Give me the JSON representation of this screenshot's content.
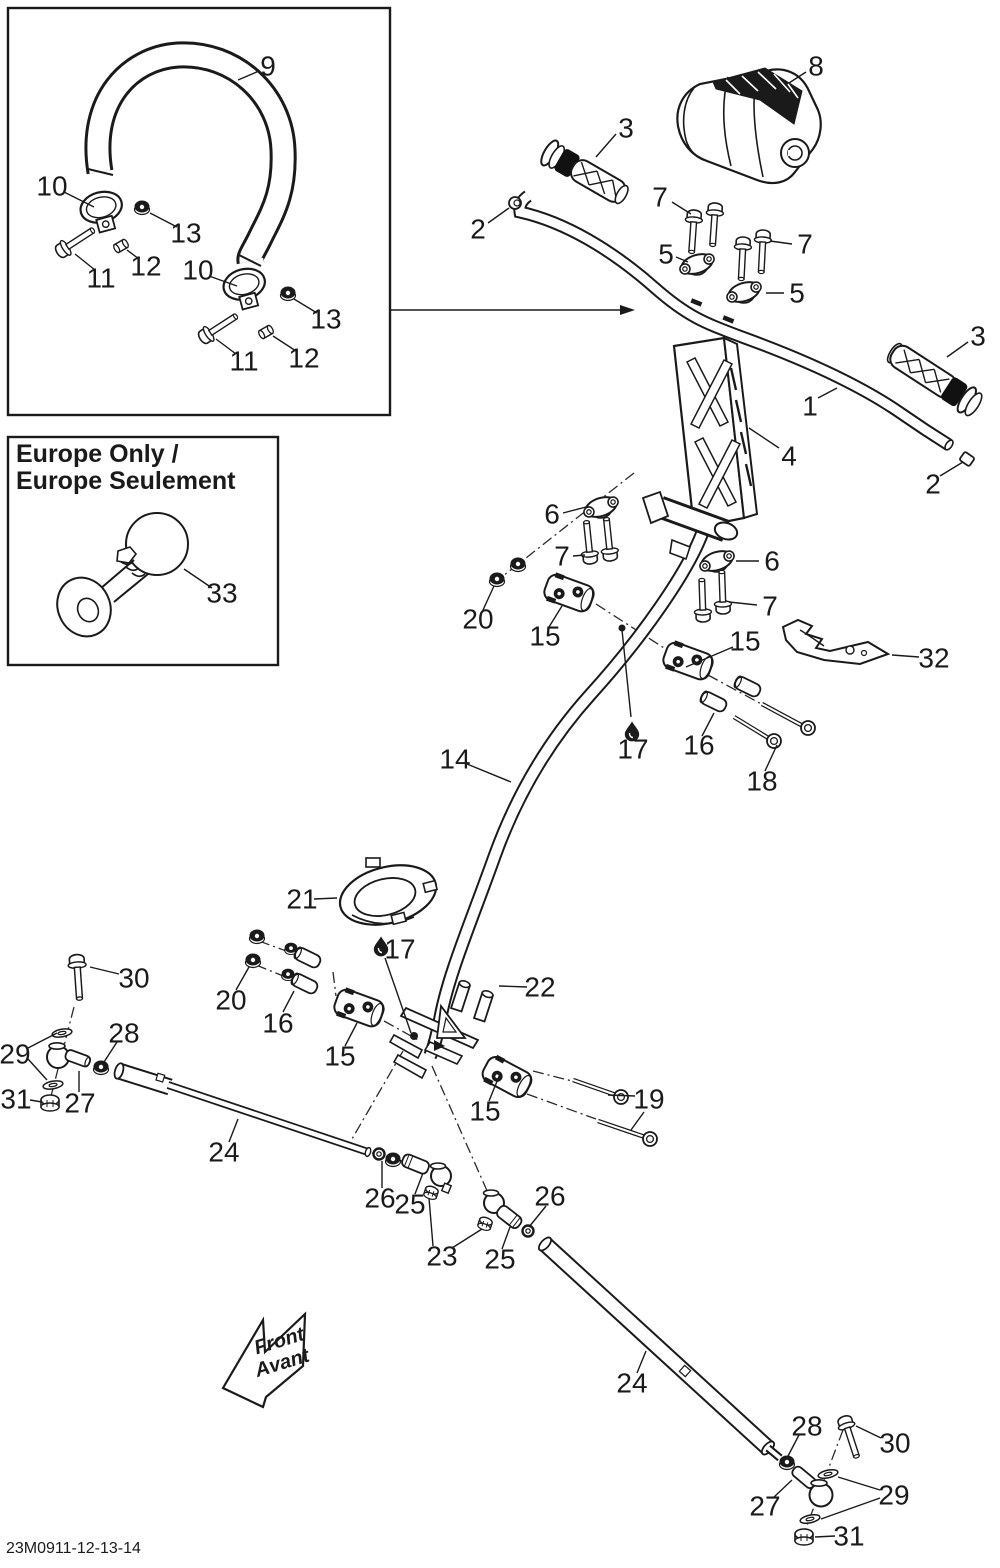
{
  "document": {
    "part_code": "23M0911-12-13-14"
  },
  "colors": {
    "line": "#1a1a1a",
    "background": "#ffffff"
  },
  "europe_box": {
    "title_line1": "Europe Only /",
    "title_line2": "Europe Seulement"
  },
  "front_arrow": {
    "line1": "Front",
    "line2": "Avant"
  },
  "callouts": [
    {
      "t": "9",
      "x": 268,
      "y": 66,
      "leaders": [
        [
          259,
          71,
          238,
          80
        ]
      ]
    },
    {
      "t": "10",
      "x": 52,
      "y": 186,
      "leaders": [
        [
          64,
          192,
          94,
          207
        ]
      ]
    },
    {
      "t": "13",
      "x": 186,
      "y": 233,
      "leaders": [
        [
          177,
          227,
          150,
          213
        ]
      ]
    },
    {
      "t": "11",
      "x": 101,
      "y": 278,
      "leaders": [
        [
          95,
          270,
          75,
          254
        ]
      ]
    },
    {
      "t": "12",
      "x": 146,
      "y": 266,
      "leaders": [
        [
          139,
          259,
          127,
          250
        ]
      ]
    },
    {
      "t": "10",
      "x": 198,
      "y": 270,
      "leaders": [
        [
          209,
          276,
          237,
          286
        ]
      ]
    },
    {
      "t": "13",
      "x": 326,
      "y": 319,
      "leaders": [
        [
          317,
          313,
          294,
          299
        ]
      ]
    },
    {
      "t": "11",
      "x": 244,
      "y": 361,
      "leaders": [
        [
          236,
          354,
          216,
          339
        ]
      ]
    },
    {
      "t": "12",
      "x": 304,
      "y": 358,
      "leaders": [
        [
          296,
          351,
          273,
          336
        ]
      ]
    },
    {
      "t": "33",
      "x": 222,
      "y": 593,
      "leaders": [
        [
          212,
          588,
          184,
          569
        ]
      ]
    },
    {
      "t": "8",
      "x": 816,
      "y": 66,
      "leaders": [
        [
          806,
          72,
          789,
          83
        ]
      ]
    },
    {
      "t": "3",
      "x": 626,
      "y": 128,
      "leaders": [
        [
          616,
          134,
          596,
          157
        ]
      ]
    },
    {
      "t": "2",
      "x": 478,
      "y": 229,
      "leaders": [
        [
          488,
          223,
          509,
          208
        ]
      ]
    },
    {
      "t": "7",
      "x": 660,
      "y": 197,
      "leaders": [
        [
          672,
          202,
          691,
          214
        ]
      ]
    },
    {
      "t": "5",
      "x": 666,
      "y": 254,
      "leaders": [
        [
          676,
          257,
          688,
          262
        ]
      ]
    },
    {
      "t": "7",
      "x": 805,
      "y": 244,
      "leaders": [
        [
          792,
          244,
          770,
          241
        ]
      ]
    },
    {
      "t": "5",
      "x": 797,
      "y": 293,
      "leaders": [
        [
          784,
          293,
          766,
          293
        ]
      ]
    },
    {
      "t": "1",
      "x": 810,
      "y": 406,
      "leaders": [
        [
          818,
          398,
          837,
          388
        ]
      ]
    },
    {
      "t": "4",
      "x": 789,
      "y": 456,
      "leaders": [
        [
          779,
          448,
          749,
          428
        ]
      ]
    },
    {
      "t": "3",
      "x": 978,
      "y": 336,
      "leaders": [
        [
          968,
          342,
          947,
          357
        ]
      ]
    },
    {
      "t": "2",
      "x": 933,
      "y": 484,
      "leaders": [
        [
          940,
          476,
          963,
          462
        ]
      ]
    },
    {
      "t": "6",
      "x": 552,
      "y": 514,
      "leaders": [
        [
          563,
          513,
          586,
          507
        ]
      ]
    },
    {
      "t": "7",
      "x": 562,
      "y": 556,
      "leaders": [
        [
          573,
          556,
          585,
          555
        ]
      ]
    },
    {
      "t": "6",
      "x": 772,
      "y": 561,
      "leaders": [
        [
          759,
          561,
          736,
          561
        ]
      ]
    },
    {
      "t": "7",
      "x": 770,
      "y": 606,
      "leaders": [
        [
          757,
          605,
          729,
          602
        ]
      ]
    },
    {
      "t": "20",
      "x": 478,
      "y": 619,
      "leaders": [
        [
          483,
          610,
          494,
          586
        ]
      ]
    },
    {
      "t": "15",
      "x": 545,
      "y": 636,
      "leaders": [
        [
          549,
          627,
          562,
          606
        ]
      ]
    },
    {
      "t": "15",
      "x": 745,
      "y": 641,
      "leaders": [
        [
          733,
          647,
          686,
          667
        ]
      ]
    },
    {
      "t": "32",
      "x": 934,
      "y": 658,
      "leaders": [
        [
          919,
          657,
          892,
          655
        ]
      ]
    },
    {
      "t": "16",
      "x": 699,
      "y": 745,
      "leaders": [
        [
          702,
          736,
          714,
          713
        ]
      ]
    },
    {
      "t": "18",
      "x": 762,
      "y": 781,
      "leaders": [
        [
          765,
          771,
          777,
          745
        ]
      ]
    },
    {
      "t": "17",
      "x": 633,
      "y": 749,
      "leaders": [
        [
          622,
          630,
          631,
          717
        ]
      ]
    },
    {
      "t": "14",
      "x": 455,
      "y": 759,
      "leaders": [
        [
          467,
          764,
          511,
          782
        ]
      ]
    },
    {
      "t": "21",
      "x": 302,
      "y": 899,
      "leaders": [
        [
          314,
          899,
          337,
          898
        ]
      ]
    },
    {
      "t": "17",
      "x": 400,
      "y": 949,
      "leaders": [
        [
          385,
          958,
          411,
          1033
        ]
      ]
    },
    {
      "t": "22",
      "x": 540,
      "y": 987,
      "leaders": [
        [
          527,
          987,
          499,
          986
        ]
      ]
    },
    {
      "t": "16",
      "x": 278,
      "y": 1023,
      "leaders": [
        [
          283,
          1012,
          294,
          991
        ]
      ]
    },
    {
      "t": "20",
      "x": 231,
      "y": 1000,
      "leaders": [
        [
          236,
          990,
          249,
          967
        ]
      ]
    },
    {
      "t": "15",
      "x": 340,
      "y": 1056,
      "leaders": [
        [
          345,
          1046,
          357,
          1023
        ]
      ]
    },
    {
      "t": "30",
      "x": 134,
      "y": 978,
      "leaders": [
        [
          119,
          974,
          90,
          967
        ]
      ]
    },
    {
      "t": "28",
      "x": 124,
      "y": 1033,
      "leaders": [
        [
          117,
          1042,
          104,
          1062
        ]
      ]
    },
    {
      "t": "29",
      "x": 15,
      "y": 1054,
      "leaders": [
        [
          28,
          1048,
          57,
          1033
        ],
        [
          28,
          1059,
          47,
          1080
        ]
      ]
    },
    {
      "t": "27",
      "x": 80,
      "y": 1103,
      "leaders": [
        [
          79,
          1092,
          79,
          1071
        ]
      ]
    },
    {
      "t": "31",
      "x": 16,
      "y": 1099,
      "leaders": [
        [
          30,
          1100,
          42,
          1102
        ]
      ]
    },
    {
      "t": "24",
      "x": 224,
      "y": 1152,
      "leaders": [
        [
          229,
          1142,
          238,
          1119
        ]
      ]
    },
    {
      "t": "19",
      "x": 649,
      "y": 1099,
      "leaders": [
        [
          635,
          1096,
          608,
          1095
        ],
        [
          644,
          1112,
          631,
          1130
        ]
      ]
    },
    {
      "t": "15",
      "x": 485,
      "y": 1111,
      "leaders": [
        [
          489,
          1101,
          500,
          1074
        ]
      ]
    },
    {
      "t": "26",
      "x": 380,
      "y": 1198,
      "leaders": [
        [
          382,
          1188,
          382,
          1161
        ]
      ]
    },
    {
      "t": "25",
      "x": 410,
      "y": 1204,
      "leaders": [
        [
          415,
          1194,
          423,
          1173
        ]
      ]
    },
    {
      "t": "23",
      "x": 442,
      "y": 1256,
      "leaders": [
        [
          433,
          1246,
          429,
          1198
        ],
        [
          452,
          1248,
          482,
          1229
        ]
      ]
    },
    {
      "t": "26",
      "x": 550,
      "y": 1196,
      "leaders": [
        [
          546,
          1206,
          529,
          1227
        ]
      ]
    },
    {
      "t": "25",
      "x": 500,
      "y": 1259,
      "leaders": [
        [
          502,
          1249,
          510,
          1227
        ]
      ]
    },
    {
      "t": "24",
      "x": 632,
      "y": 1383,
      "leaders": [
        [
          637,
          1373,
          646,
          1351
        ]
      ]
    },
    {
      "t": "28",
      "x": 807,
      "y": 1426,
      "leaders": [
        [
          799,
          1435,
          788,
          1456
        ]
      ]
    },
    {
      "t": "30",
      "x": 895,
      "y": 1443,
      "leaders": [
        [
          881,
          1438,
          856,
          1426
        ]
      ]
    },
    {
      "t": "29",
      "x": 894,
      "y": 1495,
      "leaders": [
        [
          880,
          1490,
          838,
          1477
        ],
        [
          880,
          1498,
          821,
          1519
        ]
      ]
    },
    {
      "t": "27",
      "x": 765,
      "y": 1506,
      "leaders": [
        [
          773,
          1498,
          792,
          1480
        ]
      ]
    },
    {
      "t": "31",
      "x": 849,
      "y": 1536,
      "leaders": [
        [
          835,
          1536,
          815,
          1537
        ]
      ]
    }
  ]
}
